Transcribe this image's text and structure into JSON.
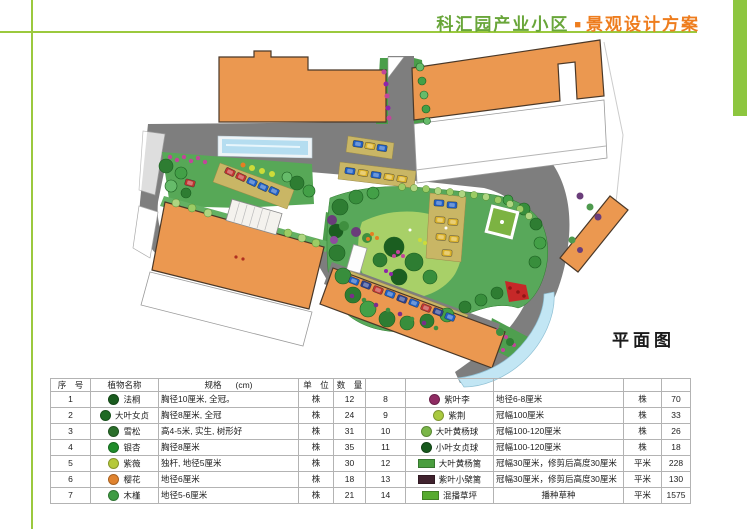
{
  "page": {
    "background": "#ffffff",
    "accent_green": "#8dc63f",
    "title_green": "#69a63a",
    "title_orange": "#ee7d1e"
  },
  "header": {
    "title_primary": "科汇园产业小区",
    "separator": "■",
    "title_secondary": "景观设计方案"
  },
  "plan": {
    "label": "平面图"
  },
  "table": {
    "headers": {
      "no": "序　号",
      "name": "植物名称",
      "spec": "规格",
      "spec_unit": "(cm)",
      "unit": "单　位",
      "qty": "数　量"
    },
    "rows_left": [
      {
        "no": "1",
        "name": "法桐",
        "spec": "胸径10厘米, 全冠。",
        "unit": "株",
        "qty": "12",
        "icon_shape": "circle",
        "icon_color": "#1a5c1f"
      },
      {
        "no": "2",
        "name": "大叶女贞",
        "spec": "胸径8厘米, 全冠",
        "unit": "株",
        "qty": "24",
        "icon_shape": "circle",
        "icon_color": "#1e6a23"
      },
      {
        "no": "3",
        "name": "雪松",
        "spec": "高4-5米, 实生, 树形好",
        "unit": "株",
        "qty": "31",
        "icon_shape": "circle",
        "icon_color": "#2a6e2a"
      },
      {
        "no": "4",
        "name": "银杏",
        "spec": "胸径8厘米",
        "unit": "株",
        "qty": "35",
        "icon_shape": "circle",
        "icon_color": "#1f8c2a"
      },
      {
        "no": "5",
        "name": "紫薇",
        "spec": "独杆, 地径5厘米",
        "unit": "株",
        "qty": "30",
        "icon_shape": "circle",
        "icon_color": "#b5c93a"
      },
      {
        "no": "6",
        "name": "樱花",
        "spec": "地径6厘米",
        "unit": "株",
        "qty": "18",
        "icon_shape": "circle",
        "icon_color": "#e0832f"
      },
      {
        "no": "7",
        "name": "木槿",
        "spec": "地径5-6厘米",
        "unit": "株",
        "qty": "21",
        "icon_shape": "circle",
        "icon_color": "#3f9b43"
      }
    ],
    "rows_right": [
      {
        "no": "8",
        "name": "紫叶李",
        "spec": "地径6-8厘米",
        "unit": "株",
        "qty": "70",
        "icon_shape": "circle",
        "icon_color": "#8e2a62"
      },
      {
        "no": "9",
        "name": "紫荆",
        "spec": "冠幅100厘米",
        "unit": "株",
        "qty": "33",
        "icon_shape": "circle",
        "icon_color": "#a9c93f"
      },
      {
        "no": "10",
        "name": "大叶黄杨球",
        "spec": "冠幅100-120厘米",
        "unit": "株",
        "qty": "26",
        "icon_shape": "circle",
        "icon_color": "#7ab648"
      },
      {
        "no": "11",
        "name": "小叶女贞球",
        "spec": "冠幅100-120厘米",
        "unit": "株",
        "qty": "18",
        "icon_shape": "circle",
        "icon_color": "#17591c"
      },
      {
        "no": "12",
        "name": "大叶黄杨篱",
        "spec": "冠幅30厘米，修剪后高度30厘米",
        "unit": "平米",
        "qty": "228",
        "icon_shape": "rect",
        "icon_color": "#4a9e3f"
      },
      {
        "no": "13",
        "name": "紫叶小檗篱",
        "spec": "冠幅30厘米，修剪后高度30厘米",
        "unit": "平米",
        "qty": "130",
        "icon_shape": "rect",
        "icon_color": "#40222e"
      },
      {
        "no": "14",
        "name": "混播草坪",
        "spec": "播种草种",
        "unit": "平米",
        "qty": "1575",
        "icon_shape": "rect",
        "icon_color": "#57ab2f",
        "spec_center": true
      }
    ]
  }
}
